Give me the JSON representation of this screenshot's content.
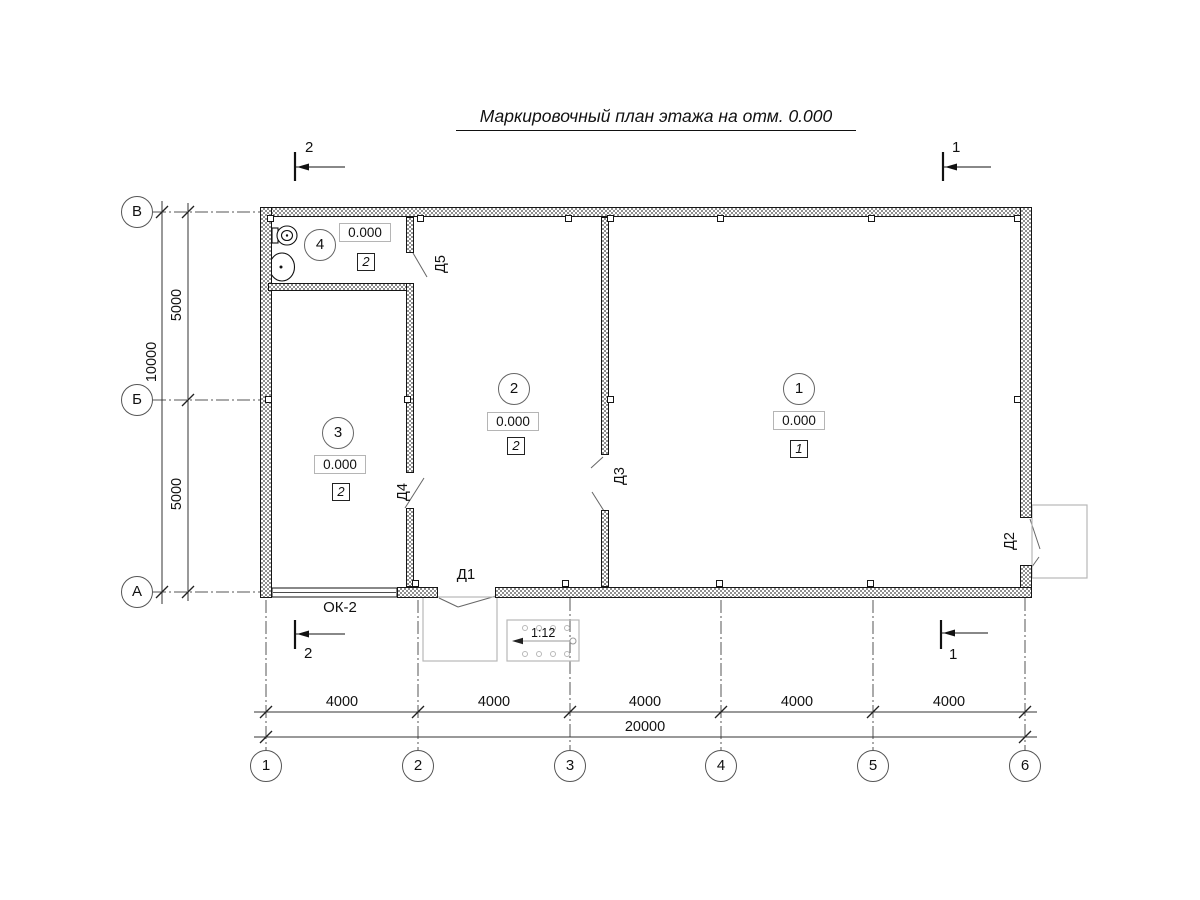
{
  "title": "Маркировочный план этажа на отм. 0.000",
  "rooms": {
    "r1": {
      "num": "1",
      "elev": "0.000",
      "finish": "1"
    },
    "r2": {
      "num": "2",
      "elev": "0.000",
      "finish": "2"
    },
    "r3": {
      "num": "3",
      "elev": "0.000",
      "finish": "2"
    },
    "r4": {
      "num": "4",
      "elev": "0.000",
      "finish": "2"
    }
  },
  "doors": {
    "d1": "Д1",
    "d2": "Д2",
    "d3": "Д3",
    "d4": "Д4",
    "d5": "Д5"
  },
  "window": {
    "label": "ОК-2"
  },
  "ramp": {
    "slope": "1:12"
  },
  "sections": {
    "sec1": "1",
    "sec2": "2"
  },
  "grid": {
    "cols": [
      "1",
      "2",
      "3",
      "4",
      "5",
      "6"
    ],
    "rows": [
      "В",
      "Б",
      "А"
    ]
  },
  "dims": {
    "col_spans": [
      "4000",
      "4000",
      "4000",
      "4000",
      "4000"
    ],
    "col_total": "20000",
    "row_spans": [
      "5000",
      "5000"
    ],
    "row_total": "10000"
  },
  "colors": {
    "line": "#111111",
    "porch": "#b8b8b8",
    "wall_hatch": "#8f8f8f"
  }
}
